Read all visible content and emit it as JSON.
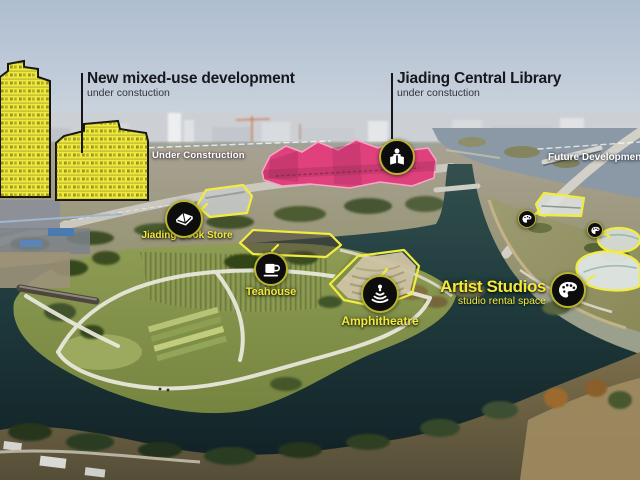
{
  "callouts": {
    "mixed_use": {
      "title": "New mixed-use development",
      "subtitle": "under constuction"
    },
    "library": {
      "title": "Jiading Central Library",
      "subtitle": "under constuction"
    }
  },
  "area_labels": {
    "under_construction": "Under Construction",
    "future_development": "Future Development"
  },
  "pois": {
    "book_store": {
      "label": "Jiading Book Store",
      "icon": "open-book-icon"
    },
    "teahouse": {
      "label": "Teahouse",
      "icon": "teacup-icon"
    },
    "amphitheatre": {
      "label": "Amphitheatre",
      "icon": "amphitheatre-tiers-icon"
    },
    "artist_studios": {
      "label": "Artist Studios",
      "sublabel": "studio rental space",
      "icon": "palette-icon"
    },
    "library_marker": {
      "icon": "reading-person-icon"
    }
  },
  "colors": {
    "highlight_yellow": "#efe93e",
    "highlight_pink": "#e0417d",
    "annotation_yellow": "#f2ec3f",
    "label_yellow": "#f3e93a",
    "callout_text": "#17171c",
    "area_label_white": "#ffffff",
    "marker_background": "#0d0d0d",
    "water_dark": "#16262b",
    "sky_top": "#aebdd0"
  }
}
